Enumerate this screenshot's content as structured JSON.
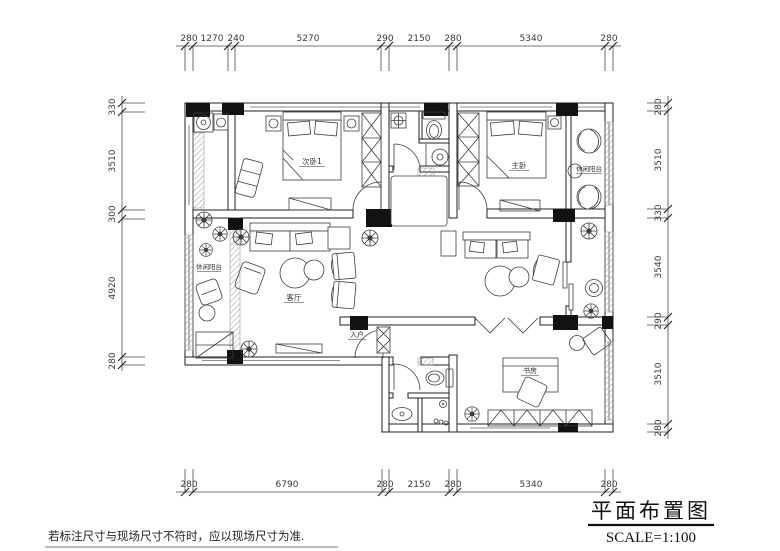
{
  "drawing": {
    "title": "平面布置图",
    "scale": "SCALE=1:100",
    "note": "若标注尺寸与现场尺寸不符时，应以现场尺寸为准."
  },
  "dimensions": {
    "top": [
      "280",
      "1270",
      "240",
      "5270",
      "290",
      "2150",
      "280",
      "5340",
      "280"
    ],
    "bottom": [
      "280",
      "6790",
      "280",
      "2150",
      "280",
      "5340",
      "280"
    ],
    "left": [
      "330",
      "3510",
      "300",
      "4920",
      "280"
    ],
    "right": [
      "280",
      "3510",
      "330",
      "3540",
      "290",
      "3510",
      "280"
    ]
  },
  "rooms": {
    "bedroom2": "次卧1",
    "master_bedroom": "主卧",
    "living_room": "客厅",
    "entry": "入户",
    "study": "书房",
    "balcony_left": "休闲阳台",
    "balcony_master": "休闲阳台"
  }
}
